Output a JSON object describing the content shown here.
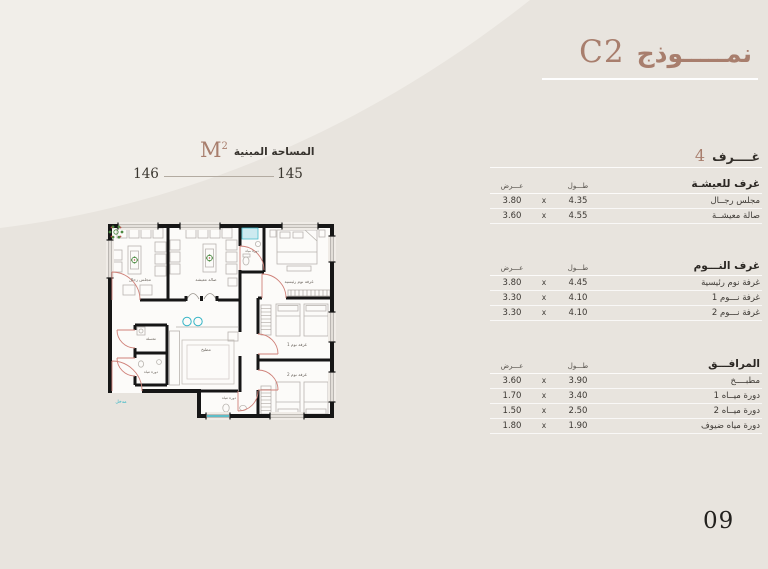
{
  "page": {
    "title_ar": "نمـــــوذج",
    "model_code": "C2",
    "page_number": "09"
  },
  "area": {
    "label_ar": "المساحة المبنية",
    "unit": "M",
    "unit_sup": "2",
    "value_left": "146",
    "value_right": "145"
  },
  "rooms_count": {
    "number": "4",
    "label": "غــــرف"
  },
  "table": {
    "col_length": "طـــول",
    "col_width": "عـــرض",
    "multiply": "x",
    "sections": [
      {
        "title": "غرف للعيشـة",
        "rows": [
          {
            "name": "مجلس رجــال",
            "length": "4.35",
            "width": "3.80"
          },
          {
            "name": "صالة معيشــة",
            "length": "4.55",
            "width": "3.60"
          }
        ]
      },
      {
        "title": "غرف النـــوم",
        "rows": [
          {
            "name": "غرفة نوم رئيسية",
            "length": "4.45",
            "width": "3.80"
          },
          {
            "name": "غرفة نـــوم 1",
            "length": "4.10",
            "width": "3.30"
          },
          {
            "name": "غرفة نـــوم 2",
            "length": "4.10",
            "width": "3.30"
          }
        ]
      },
      {
        "title": "المرافـــق",
        "rows": [
          {
            "name": "مطبــــخ",
            "length": "3.90",
            "width": "3.60"
          },
          {
            "name": "دورة ميــاه 1",
            "length": "3.40",
            "width": "1.70"
          },
          {
            "name": "دورة ميــاه 2",
            "length": "2.50",
            "width": "1.50"
          },
          {
            "name": "دورة مياه ضيوف",
            "length": "1.90",
            "width": "1.80"
          }
        ]
      }
    ]
  },
  "plan": {
    "labels": {
      "majlis": "مجلس رجال",
      "living": "صالة معيشة",
      "master": "غرفة نوم رئيسية",
      "bedroom1": "غرفة نوم 1",
      "bedroom2": "غرفة نوم 2",
      "kitchen": "مطبخ",
      "laundry": "مغسلة",
      "bath_top": "دورة مياه",
      "bath_left": "دورة مياه",
      "bath_bottom": "دورة مياه",
      "entrance": "مدخل"
    },
    "colors": {
      "wall": "#161616",
      "door": "#cf8179",
      "water": "#35b5c6",
      "plant": "#4c8a42",
      "furniture": "#b8b4af"
    }
  },
  "colors": {
    "accent": "#a87e6d",
    "background": "#e8e4de",
    "panel": "#f1eee9"
  }
}
